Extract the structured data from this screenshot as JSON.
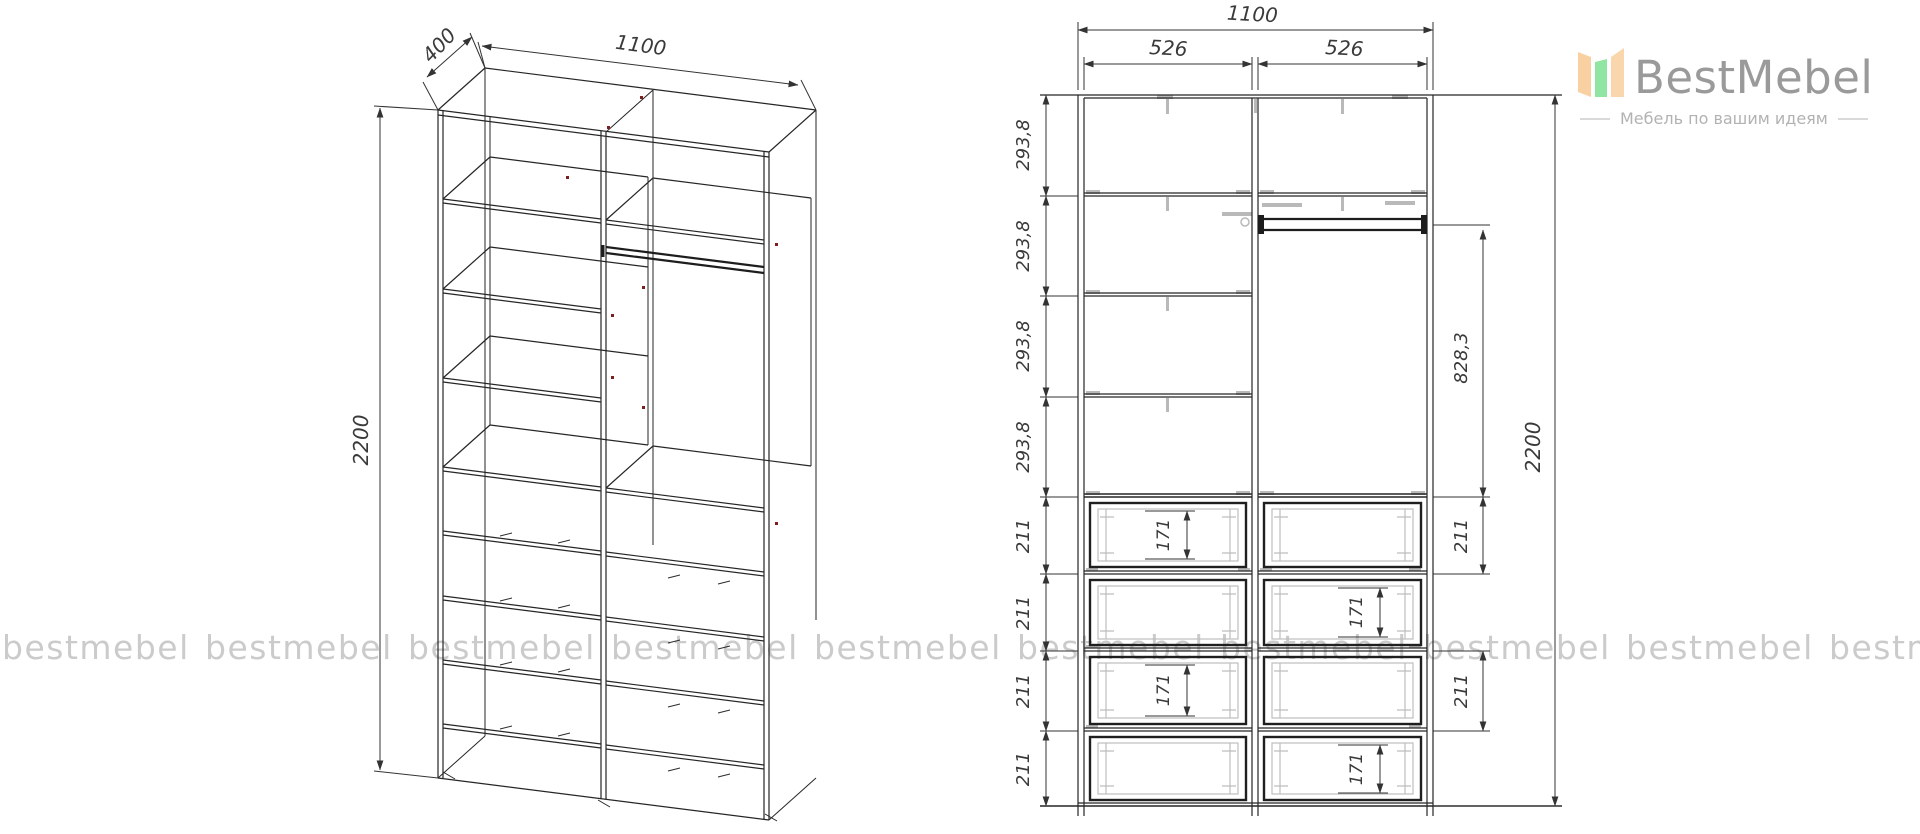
{
  "brand": {
    "name": "BestMebel",
    "tagline": "Мебель по вашим идеям"
  },
  "watermark": {
    "text": "bestmebel"
  },
  "iso_view": {
    "width": "1100",
    "depth": "400",
    "height": "2200"
  },
  "front_view": {
    "total_width": "1100",
    "left_column_width": "526",
    "right_column_width": "526",
    "shelf_sections": [
      "293,8",
      "293,8",
      "293,8",
      "293,8"
    ],
    "left_drawer_heights": [
      "211",
      "211",
      "211",
      "211"
    ],
    "right_drawer_heights": [
      "211",
      "211"
    ],
    "drawer_front_heights": [
      "171",
      "171",
      "171",
      "171"
    ],
    "hanging_space_height": "828,3",
    "total_height": "2200"
  }
}
